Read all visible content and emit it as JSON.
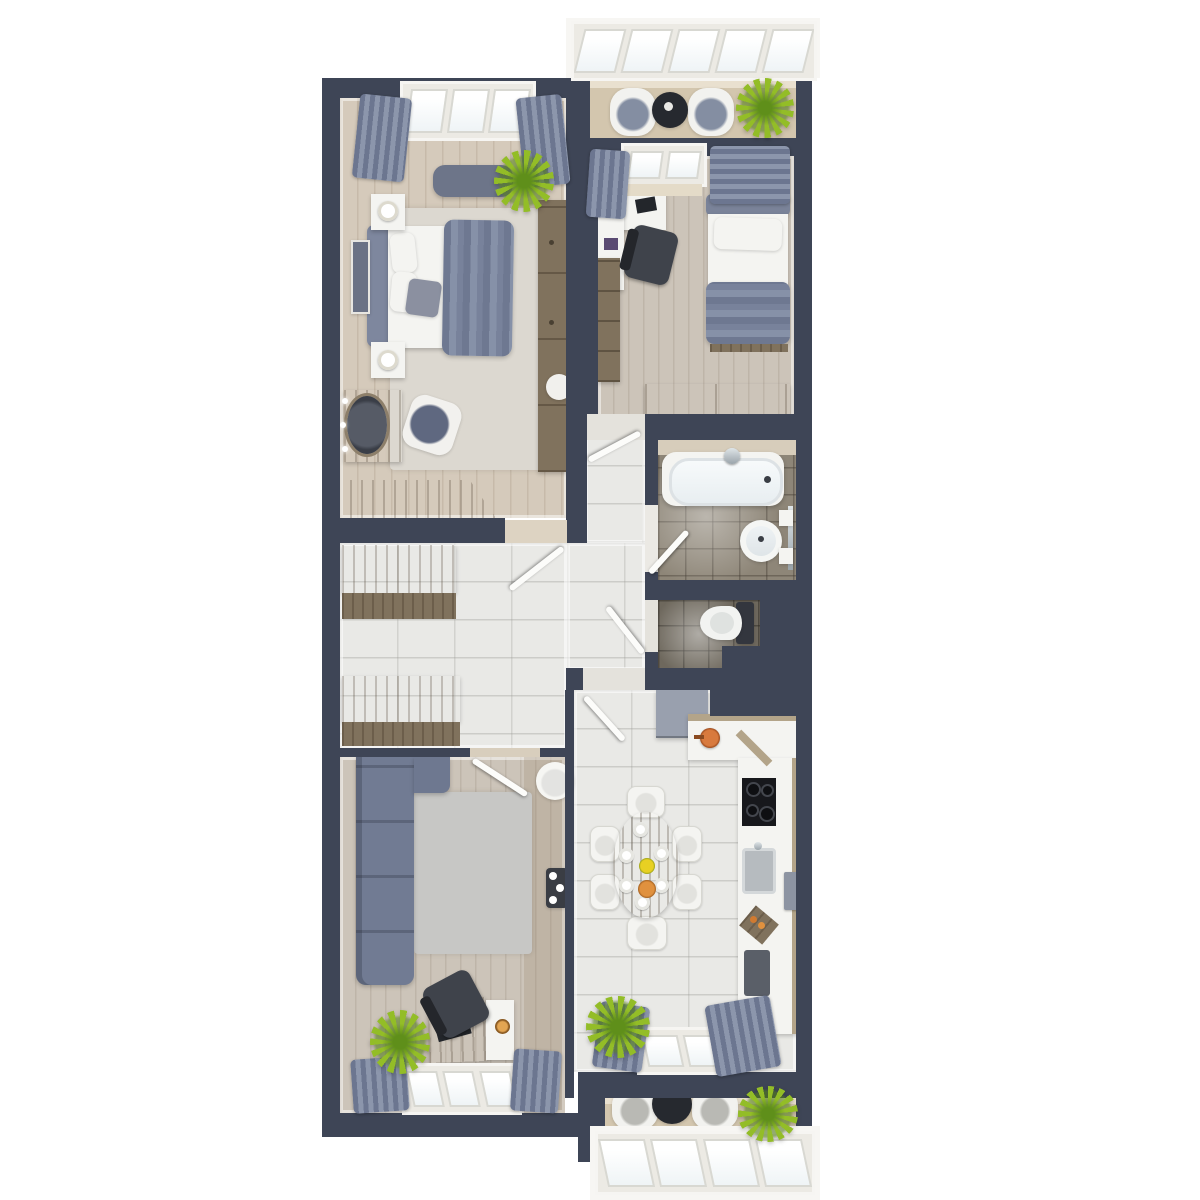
{
  "title": "3D top-down apartment floor plan render",
  "palette": {
    "bg": "#ffffff",
    "wall": "#3e4556",
    "wood-floor": "#d5cabb",
    "wood-floor-gray": "#ccc4b9",
    "marble": "#e9e9e6",
    "bath-floor": "#8e8678",
    "toilet-floor": "#6e685d",
    "balcony-floor": "#d3c6ae",
    "rug-light": "#dcd8d0",
    "rug-gray": "#c7c7c5",
    "sofa": "#717b93",
    "sofa-dark": "#5f6880",
    "curtain": "#7d87a0",
    "wood-furn": "#95866f",
    "wood-furn-dark": "#80725d",
    "white-furn": "#f4f4f1",
    "chair-dark": "#3f434b",
    "plant": "#93bd27",
    "plant-dark": "#5f8f1a",
    "glass": "#eff4f6",
    "chrome": "#b9c2c8",
    "copper": "#c06530",
    "fridge": "#99a0ae",
    "counter-wood": "#b3a489",
    "appliance": "#17181c"
  },
  "rooms": [
    {
      "name": "master-bedroom",
      "furniture": [
        "double-bed",
        "nightstand-with-lamp",
        "nightstand-with-lamp",
        "window-bench",
        "wardrobe",
        "vanity-with-mirror",
        "vanity-chair",
        "dresser",
        "rug",
        "plant",
        "wall-art",
        "window",
        "curtains"
      ]
    },
    {
      "name": "second-bedroom",
      "furniture": [
        "single-bed",
        "desk",
        "office-chair",
        "bookshelf",
        "dresser",
        "window",
        "curtains"
      ]
    },
    {
      "name": "bathroom",
      "furniture": [
        "bathtub",
        "round-basin",
        "towel-rail",
        "door"
      ]
    },
    {
      "name": "toilet-room",
      "furniture": [
        "toilet"
      ]
    },
    {
      "name": "hallway",
      "furniture": [
        "storage-cabinet",
        "shoe-bench",
        "doors"
      ]
    },
    {
      "name": "living-room",
      "furniture": [
        "corner-sofa",
        "rug",
        "round-armchair",
        "flower-table",
        "desk",
        "office-chair",
        "laptop",
        "plant",
        "window",
        "curtains"
      ]
    },
    {
      "name": "kitchen-dining",
      "furniture": [
        "oval-dining-table",
        "six-chairs",
        "plates",
        "fruit-bowls",
        "fridge",
        "l-shaped-counter",
        "cooktop",
        "sink",
        "cutting-board",
        "plant",
        "window",
        "curtains"
      ]
    },
    {
      "name": "balcony-top",
      "furniture": [
        "armchair",
        "armchair",
        "round-table",
        "plant",
        "glazing"
      ]
    },
    {
      "name": "balcony-bottom",
      "furniture": [
        "armchair",
        "armchair",
        "round-table",
        "plant",
        "glazing"
      ]
    }
  ]
}
